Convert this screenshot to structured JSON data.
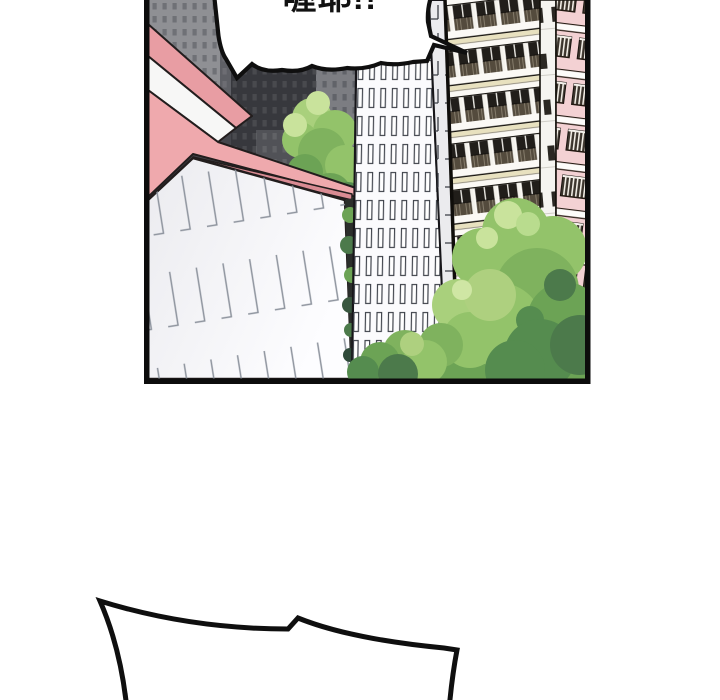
{
  "page": {
    "background_color": "#ffffff",
    "kind": "webtoon-comic-panel"
  },
  "panel": {
    "border_color": "#0c0c0c",
    "speech_bubble": {
      "text": "喔耶!!",
      "fill": "#ffffff",
      "outline_color": "#0f0f0f",
      "text_color": "#111111"
    },
    "bottom_bubble": {
      "fill": "#ffffff",
      "outline_color": "#0f0f0f"
    },
    "scene": {
      "elements": [
        "city-skyline",
        "pink-roof-house",
        "office-tower",
        "apartment-building",
        "trees"
      ],
      "palette": {
        "skyline_base": "#45464c",
        "skyline_dark": "#37383d",
        "skyline_light": "#8f9094",
        "roof_pink": "#efa9ad",
        "roof_upper_pink": "#e89da3",
        "roof_fascia": "#f7f7f6",
        "house_wall": "#f1f1f4",
        "tower_white": "#fbfbfd",
        "tower_line": "#42464e",
        "apartment_face": "#fbf9f5",
        "apartment_slab": "#e8e1bf",
        "apartment_window": "#211e1a",
        "apartment_side_pink": "#f3d1d3",
        "tree_highlight": "#c9e39c",
        "tree_light": "#a9d07c",
        "tree_mid": "#93c36a",
        "tree_dark": "#6ca355",
        "tree_deep": "#4c7a4b"
      }
    }
  }
}
